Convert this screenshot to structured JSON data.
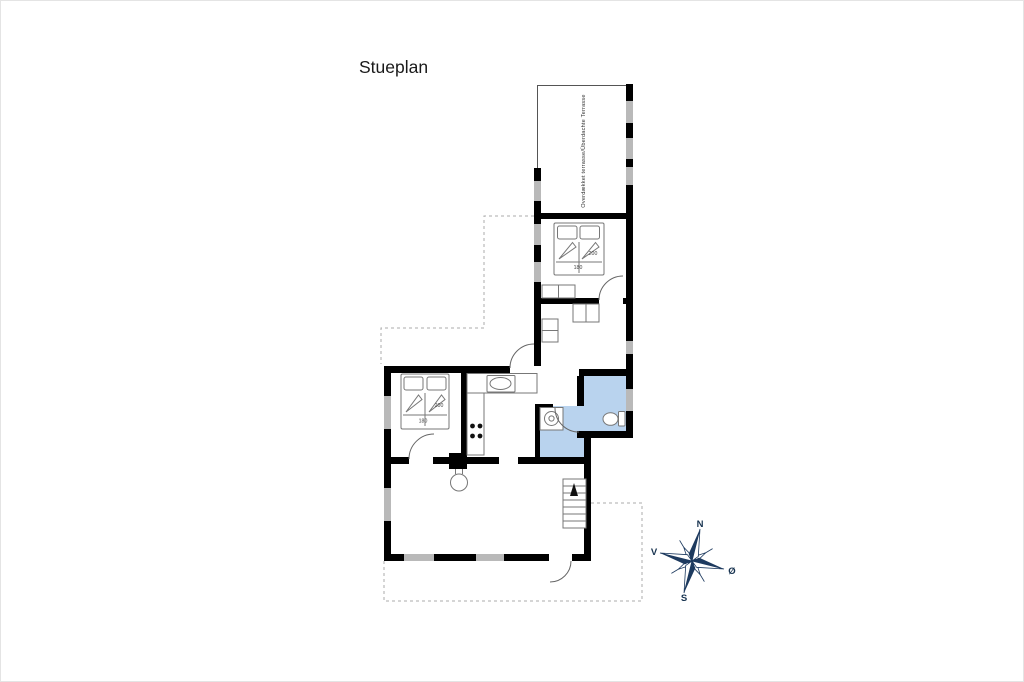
{
  "page": {
    "title": "Stueplan"
  },
  "plan": {
    "covered_terrace_label": "Overdækket terrasse/Überdachte Terrasse",
    "beds": {
      "bedroom1": {
        "length_cm": "200",
        "width_cm": "180"
      },
      "bedroom2": {
        "length_cm": "200",
        "width_cm": "180"
      }
    },
    "compass": {
      "north": "N",
      "east": "Ø",
      "south": "S",
      "west": "V"
    }
  },
  "colors": {
    "wall": "#000000",
    "window": "#b9b9b9",
    "wet_room_fill": "#b9d3ee",
    "dashed_line": "#ababab",
    "compass_navy": "#1d3a5f",
    "background": "#ffffff"
  }
}
